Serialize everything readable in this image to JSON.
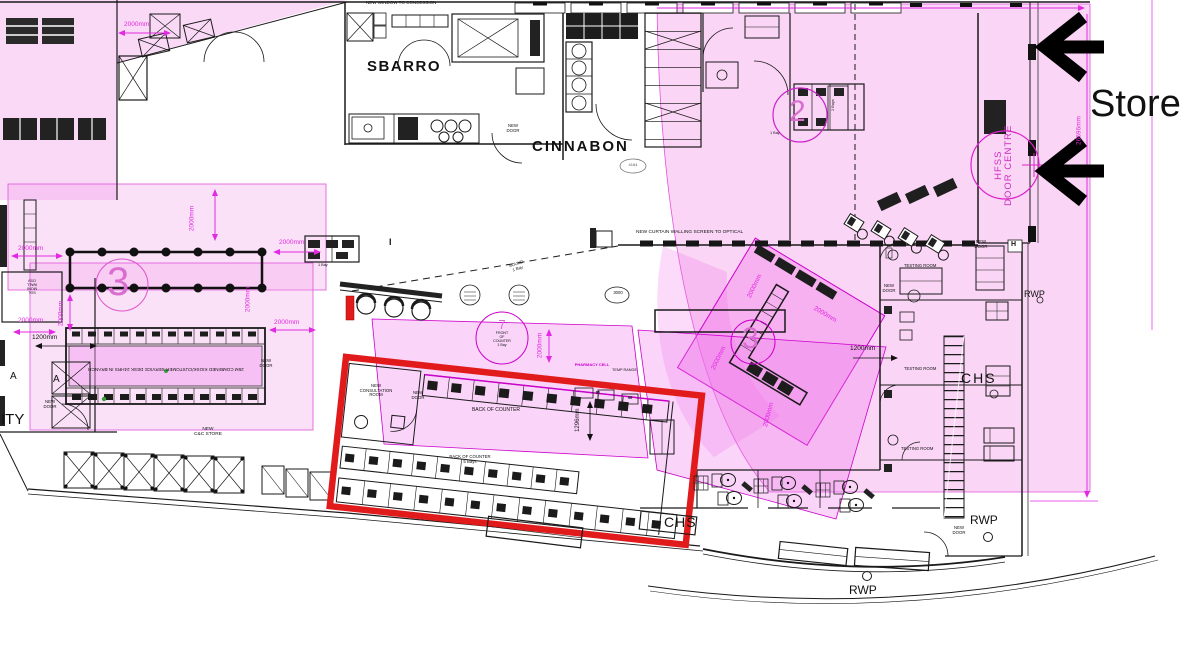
{
  "labels": {
    "store": "Store",
    "sbarro": "SBARRO",
    "cinnabon": "CINNABON",
    "new_window_concession": "NEW WINDOW TO CONCESSION",
    "curtain_screen": "NEW CURTAIN WALLING SCREEN TO OPTICAL",
    "new_l": "NEW",
    "door_l": "DOOR",
    "consultation_l": "CONSULTATION",
    "room_l": "ROOM",
    "cc_store_l": "C&C STORE",
    "kiosk_note": "25M COMBINED KIOSK/CUSTOMER SERVICE DESK 24HRS IN BRANCH",
    "back_of_counter": "BACK OF COUNTER",
    "five_bays": "5 Bays",
    "front_l": "FRONT",
    "of_l": "OF",
    "counter_l": "COUNTER",
    "one_bay": "1 Bay",
    "two_bays": "2 Bays",
    "pharmacy_cell": "PHARMACY CELL",
    "temp_range": "TEMP RANGE",
    "testing_room": "TESTING ROOM",
    "hfss": "HFSS",
    "door_centre": "DOOR CENTRE",
    "rwp": "RWP",
    "chs": "CHS",
    "sound": "SOUND",
    "n3000": "3000",
    "n4164": "4164",
    "h_marker": "H",
    "i_marker": "I",
    "a_marker": "A",
    "ity_fragment": "ITY",
    "m_marker": "M",
    "w_marker": "W",
    "wall_note_1": "SGL",
    "wall_note_2": "MONI",
    "wall_note_3": "WALL",
    "wall_note_4": "OSV"
  },
  "dims": {
    "d13242": "13242mm",
    "d26696": "26696mm",
    "d2000": "2000mm",
    "d1200": "1200mm",
    "d1296": "1296mm"
  },
  "circle_markers": {
    "c3": "3",
    "c7": "7",
    "c2": "2"
  },
  "colors": {
    "highlight_pink": "#f39ae8",
    "dimension_magenta": "#e22ae2",
    "alert_red": "#e11b1b",
    "line_black": "#1a1a1a"
  }
}
